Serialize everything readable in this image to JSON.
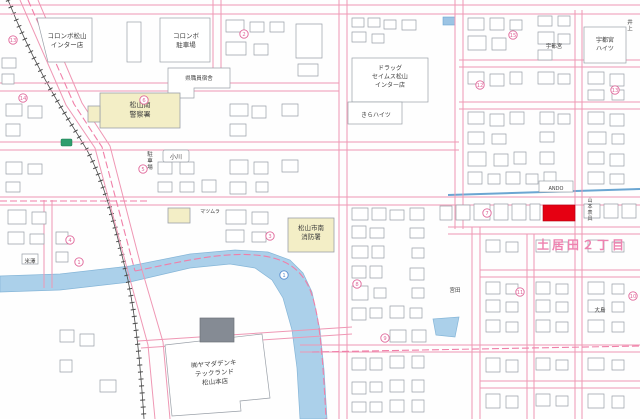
{
  "map": {
    "kind": "zenrin-style-residential-map",
    "area_name": "土居田２丁目",
    "colors": {
      "road_casing": "#ef97b4",
      "boundary_dash": "#f07fa8",
      "water": "#abd0ea",
      "building_outline": "#9aa0a8",
      "public_building_fill": "#f3eec6",
      "railway": "#4b4b4b",
      "highlight": "#e60012",
      "label_text": "#3d3d3d",
      "district_label": "#ee82b0",
      "route_badge": "#2f9e6e"
    },
    "highlight": {
      "x": 543,
      "y": 205,
      "w": 32,
      "h": 16,
      "color": "#e60012"
    },
    "labels": [
      {
        "id": "colombo-inter-store",
        "lines": [
          "コロンボ松山",
          "インター店"
        ],
        "x": 67,
        "y": 38,
        "size": 6.5
      },
      {
        "id": "colombo-parking",
        "lines": [
          "コロンボ",
          "駐車場"
        ],
        "x": 186,
        "y": 38,
        "size": 6.5
      },
      {
        "id": "pref-staff-housing",
        "lines": [
          "県職員宿舎"
        ],
        "x": 199,
        "y": 80,
        "size": 5.5
      },
      {
        "id": "police-station",
        "lines": [
          "松山南",
          "警察署"
        ],
        "x": 140,
        "y": 107,
        "size": 7
      },
      {
        "id": "ogawa",
        "lines": [
          "小川"
        ],
        "x": 176,
        "y": 159,
        "size": 6
      },
      {
        "id": "parking-vertical",
        "lines": [
          "駐車場"
        ],
        "x": 150,
        "y": 156,
        "size": 5.5,
        "vertical": true
      },
      {
        "id": "drug-seims",
        "lines": [
          "ドラッグ",
          "セイムス松山",
          "インター店"
        ],
        "x": 390,
        "y": 70,
        "size": 6
      },
      {
        "id": "kira-heights",
        "lines": [
          "きらハイツ"
        ],
        "x": 376,
        "y": 117,
        "size": 6
      },
      {
        "id": "utsunomiya-heights",
        "lines": [
          "宇都宮",
          "ハイツ"
        ],
        "x": 605,
        "y": 42,
        "size": 6
      },
      {
        "id": "utsunomiya",
        "lines": [
          "宇都宮"
        ],
        "x": 554,
        "y": 48,
        "size": 5.5
      },
      {
        "id": "inoue",
        "lines": [
          "井上"
        ],
        "x": 630,
        "y": 24,
        "size": 5.5,
        "vertical": true
      },
      {
        "id": "fire-station",
        "lines": [
          "松山市南",
          "消防署"
        ],
        "x": 311,
        "y": 230,
        "size": 6.5
      },
      {
        "id": "matsumura",
        "lines": [
          "マツムラ"
        ],
        "x": 210,
        "y": 213,
        "size": 5
      },
      {
        "id": "yamada-denki",
        "lines": [
          "㈱ヤマダデンキ",
          "テックランド",
          "松山本店"
        ],
        "x": 214,
        "y": 366,
        "size": 6.5,
        "rotate": -4
      },
      {
        "id": "district",
        "lines": [
          "土居田２丁目"
        ],
        "x": 582,
        "y": 249,
        "size": 12,
        "cls": "area"
      },
      {
        "id": "ando",
        "lines": [
          "ANDO"
        ],
        "x": 556,
        "y": 190,
        "size": 5
      },
      {
        "id": "yamamoto-hyogu",
        "lines": [
          "山本表具"
        ],
        "x": 590,
        "y": 202,
        "size": 5,
        "vertical": true
      },
      {
        "id": "oshima",
        "lines": [
          "大島"
        ],
        "x": 600,
        "y": 312,
        "size": 5.5
      },
      {
        "id": "miyata",
        "lines": [
          "宮田"
        ],
        "x": 455,
        "y": 292,
        "size": 5.5
      },
      {
        "id": "yonezawa",
        "lines": [
          "米澤"
        ],
        "x": 30,
        "y": 263,
        "size": 5.5
      }
    ],
    "lot_markers": [
      {
        "v": "13",
        "x": 13,
        "y": 40
      },
      {
        "v": "14",
        "x": 23,
        "y": 98
      },
      {
        "v": "2",
        "x": 244,
        "y": 34
      },
      {
        "v": "6",
        "x": 144,
        "y": 100
      },
      {
        "v": "15",
        "x": 513,
        "y": 35
      },
      {
        "v": "12",
        "x": 480,
        "y": 85
      },
      {
        "v": "13",
        "x": 615,
        "y": 90
      },
      {
        "v": "5",
        "x": 143,
        "y": 169
      },
      {
        "v": "4",
        "x": 70,
        "y": 240
      },
      {
        "v": "1",
        "x": 79,
        "y": 262
      },
      {
        "v": "3",
        "x": 270,
        "y": 236
      },
      {
        "v": "7",
        "x": 487,
        "y": 213
      },
      {
        "v": "8",
        "x": 357,
        "y": 284
      },
      {
        "v": "9",
        "x": 385,
        "y": 338
      },
      {
        "v": "11",
        "x": 520,
        "y": 292
      },
      {
        "v": "10",
        "x": 633,
        "y": 296
      }
    ],
    "river_markers": [
      {
        "v": "1",
        "x": 284,
        "y": 275
      }
    ]
  }
}
